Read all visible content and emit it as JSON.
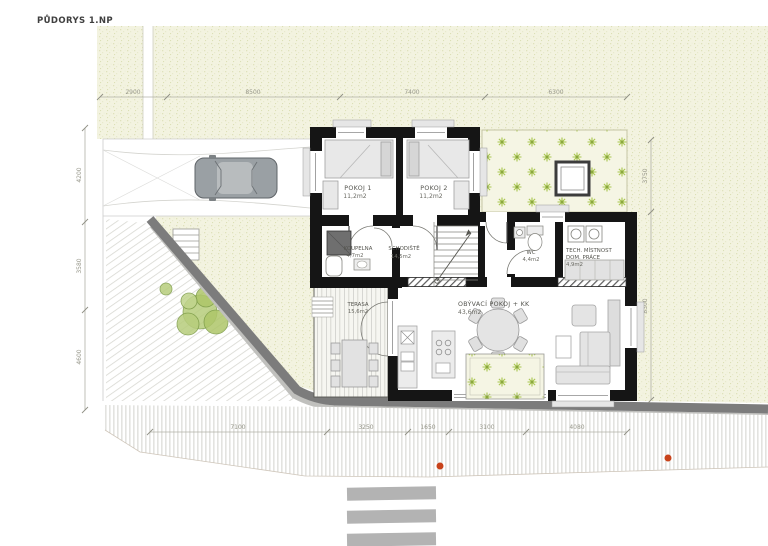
{
  "meta": {
    "title": "PŮDORYS 1.NP"
  },
  "rooms": {
    "pokoj1": {
      "name": "POKOJ 1",
      "area": "11,2m2"
    },
    "pokoj2": {
      "name": "POKOJ 2",
      "area": "11,2m2"
    },
    "koupelna": {
      "name": "KOUPELNA",
      "area": "4,7m2"
    },
    "schodiste": {
      "name": "SCHODIŠTĚ",
      "area": "14,5m2"
    },
    "wc": {
      "name": "WC",
      "area": "4,4m2"
    },
    "tech": {
      "name": "TECH. MÍSTNOST",
      "name2": "DOM. PRÁCE",
      "area": "4,9m2"
    },
    "terasa": {
      "name": "TERASA",
      "area": "15,6m2"
    },
    "obyvaci": {
      "name": "OBÝVACÍ POKOJ + KK",
      "area": "43,6m2"
    }
  },
  "dimensions": {
    "top": [
      "2900",
      "8500",
      "7400",
      "6300"
    ],
    "left": [
      "4200",
      "3580",
      "4600"
    ],
    "right": [
      "3750",
      "8300"
    ],
    "bottom": [
      "7100",
      "3250",
      "1650",
      "3100",
      "4080"
    ]
  },
  "colors": {
    "wall": "#151515",
    "grass": "#f3f3e0",
    "flower_green": "#a9c64f",
    "curb_gray": "#7c7c7c",
    "marker_orange": "#c8431b"
  }
}
